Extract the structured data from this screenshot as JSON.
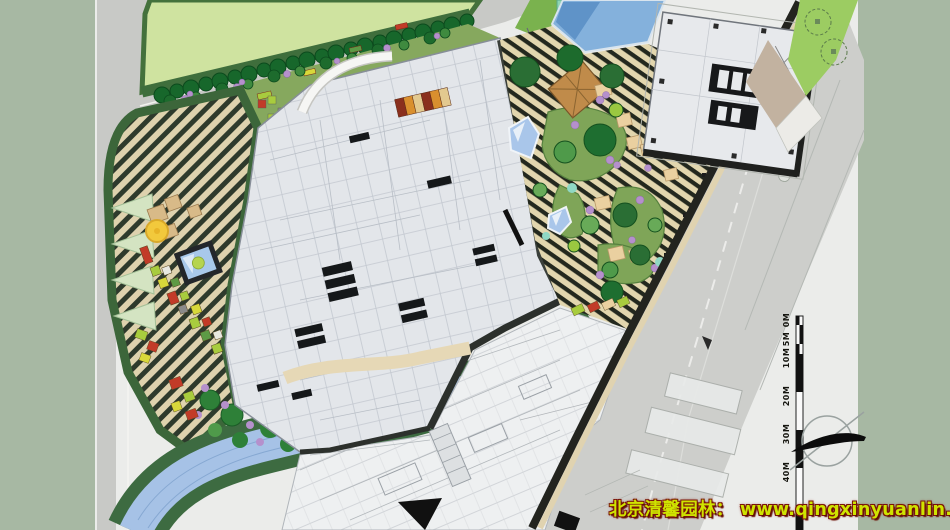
{
  "page": {
    "description": "Colored landscape master plan of a commercial complex: striped entry plaza with sunken pool, podium building, office tower, terraced roof garden, canal and perimeter roads"
  },
  "watermark": {
    "text": "北京清馨园林： www.qingxinyuanlin.com",
    "color": "#cfe400",
    "outline_color": "#7a1408"
  },
  "scale_bar": {
    "labels": [
      "0M",
      "5M",
      "10M",
      "20M",
      "30M",
      "40M"
    ]
  },
  "compass": {
    "icon": "north-arrow-icon"
  },
  "palette": {
    "margin_green": "#a7b8a3",
    "paper": "#ebecea",
    "road_gray": "#c8c9c6",
    "lawn_green": "#cfe3a0",
    "lawn_border": "#44713c",
    "street_tree": "#17672b",
    "plaza_stripe_cream": "#ded2ae",
    "plaza_stripe_dark": "#2e3a2c",
    "plaza_edge": "#3c663a",
    "roof_stripe_cream": "#e2d6ae",
    "roof_stripe_dark": "#23281e",
    "water_blue": "#a6c2e6",
    "bank_green": "#3d6b41",
    "building_gray": "#e3e6ea",
    "core_black": "#17181a",
    "shrub_purple": "#b590cc",
    "bed_red": "#c23b28",
    "bed_lime": "#a8cc3e",
    "canopy_yellow": "#f2c93c",
    "deck_tan": "#d8ba88",
    "watermark_yellow": "#cfe400"
  },
  "areas": [
    {
      "name": "perimeter-lawn",
      "color": "#cfe3a0"
    },
    {
      "name": "striped-entry-plaza",
      "color": "#ded2ae"
    },
    {
      "name": "sunken-pool",
      "color": "#a8c8ea"
    },
    {
      "name": "podium-building",
      "color": "#e3e6ea"
    },
    {
      "name": "office-tower",
      "color": "#e7e9ec"
    },
    {
      "name": "terraced-roof-garden",
      "color": "#e2d6ae"
    },
    {
      "name": "canal",
      "color": "#a6c2e6"
    },
    {
      "name": "city-road",
      "color": "#c8c9c6"
    },
    {
      "name": "background-margin",
      "color": "#a7b8a3"
    }
  ]
}
